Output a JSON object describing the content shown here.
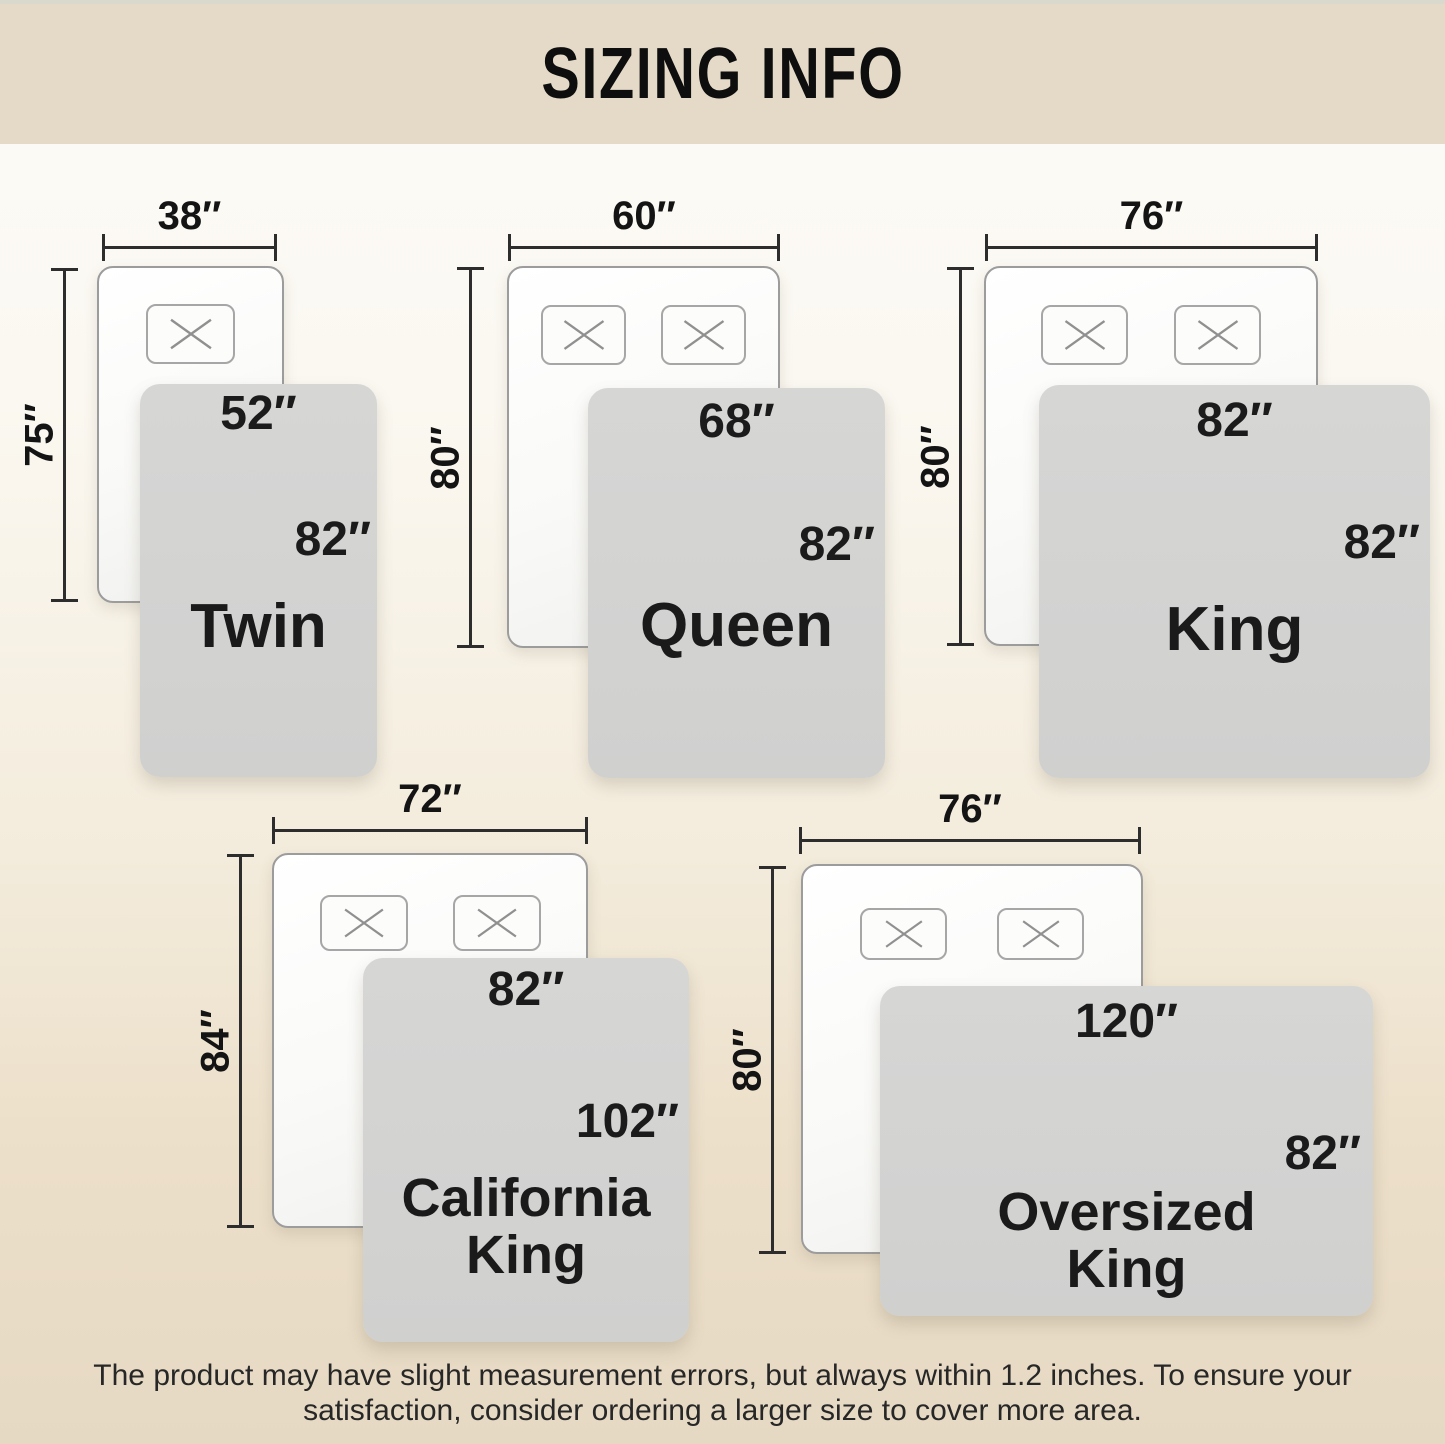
{
  "header": {
    "title": "SIZING INFO"
  },
  "sizes": [
    {
      "name": "Twin",
      "mattress_width": "38″",
      "mattress_length": "75″",
      "blanket_width": "52″",
      "blanket_length": "82″",
      "pillow_count": 1
    },
    {
      "name": "Queen",
      "mattress_width": "60″",
      "mattress_length": "80″",
      "blanket_width": "68″",
      "blanket_length": "82″",
      "pillow_count": 2
    },
    {
      "name": "King",
      "mattress_width": "76″",
      "mattress_length": "80″",
      "blanket_width": "82″",
      "blanket_length": "82″",
      "pillow_count": 2
    },
    {
      "name": "California King",
      "mattress_width": "72″",
      "mattress_length": "84″",
      "blanket_width": "82″",
      "blanket_length": "102″",
      "pillow_count": 2
    },
    {
      "name": "Oversized King",
      "mattress_width": "76″",
      "mattress_length": "80″",
      "blanket_width": "120″",
      "blanket_length": "82″",
      "pillow_count": 2
    }
  ],
  "footer": {
    "line1": "The product may have slight measurement errors, but always within 1.2 inches. To ensure your",
    "line2": "satisfaction, consider ordering a larger size to cover more area."
  },
  "colors": {
    "header_bg": "#e4dac7",
    "background_top": "#fcfbf8",
    "background_bottom": "#e6d9c3",
    "blanket": "#d3d3d2",
    "mattress_border": "#9c9c9c",
    "dimension_line": "#2d2d2d",
    "text": "#161616"
  }
}
